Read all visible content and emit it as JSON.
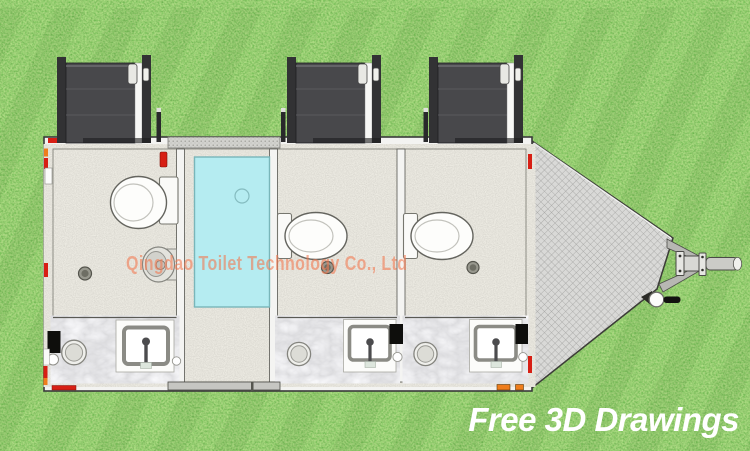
{
  "image": {
    "subject": "Three-room portable toilet trailer shown as a top-view 3D floor plan on grass",
    "view": "top-down"
  },
  "branding": {
    "watermark": "Qingdao Toilet Technology Co., Ltd",
    "tagline": "Free 3D Drawings"
  },
  "colors": {
    "grass": "#4c983b",
    "floor": "#c8c4ba",
    "marble": "#dedee0",
    "shower": "#b5ecf1",
    "door": "#48484b",
    "hatch": "#d9d9d7",
    "wall": "#f3f3f1",
    "watermark": "rgba(242,122,82,0.6)",
    "tagline": "#ffffff",
    "red": "#d71f14",
    "orange": "#ef7d1c"
  },
  "floor_plan": {
    "door_count": 3,
    "rooms": [
      {
        "name": "toilet room 1",
        "fixtures": [
          "toilet",
          "urinal",
          "washbasin",
          "counter sink",
          "floor drain"
        ]
      },
      {
        "name": "center corridor",
        "fixtures": [
          "shower tray",
          "shower drain"
        ]
      },
      {
        "name": "toilet room 2",
        "fixtures": [
          "toilet",
          "washbasin",
          "counter sink",
          "floor drain"
        ]
      },
      {
        "name": "toilet room 3",
        "fixtures": [
          "toilet",
          "washbasin",
          "counter sink",
          "floor drain"
        ]
      }
    ],
    "hitch": "A-frame drawbar with ball coupler and jockey wheel"
  }
}
